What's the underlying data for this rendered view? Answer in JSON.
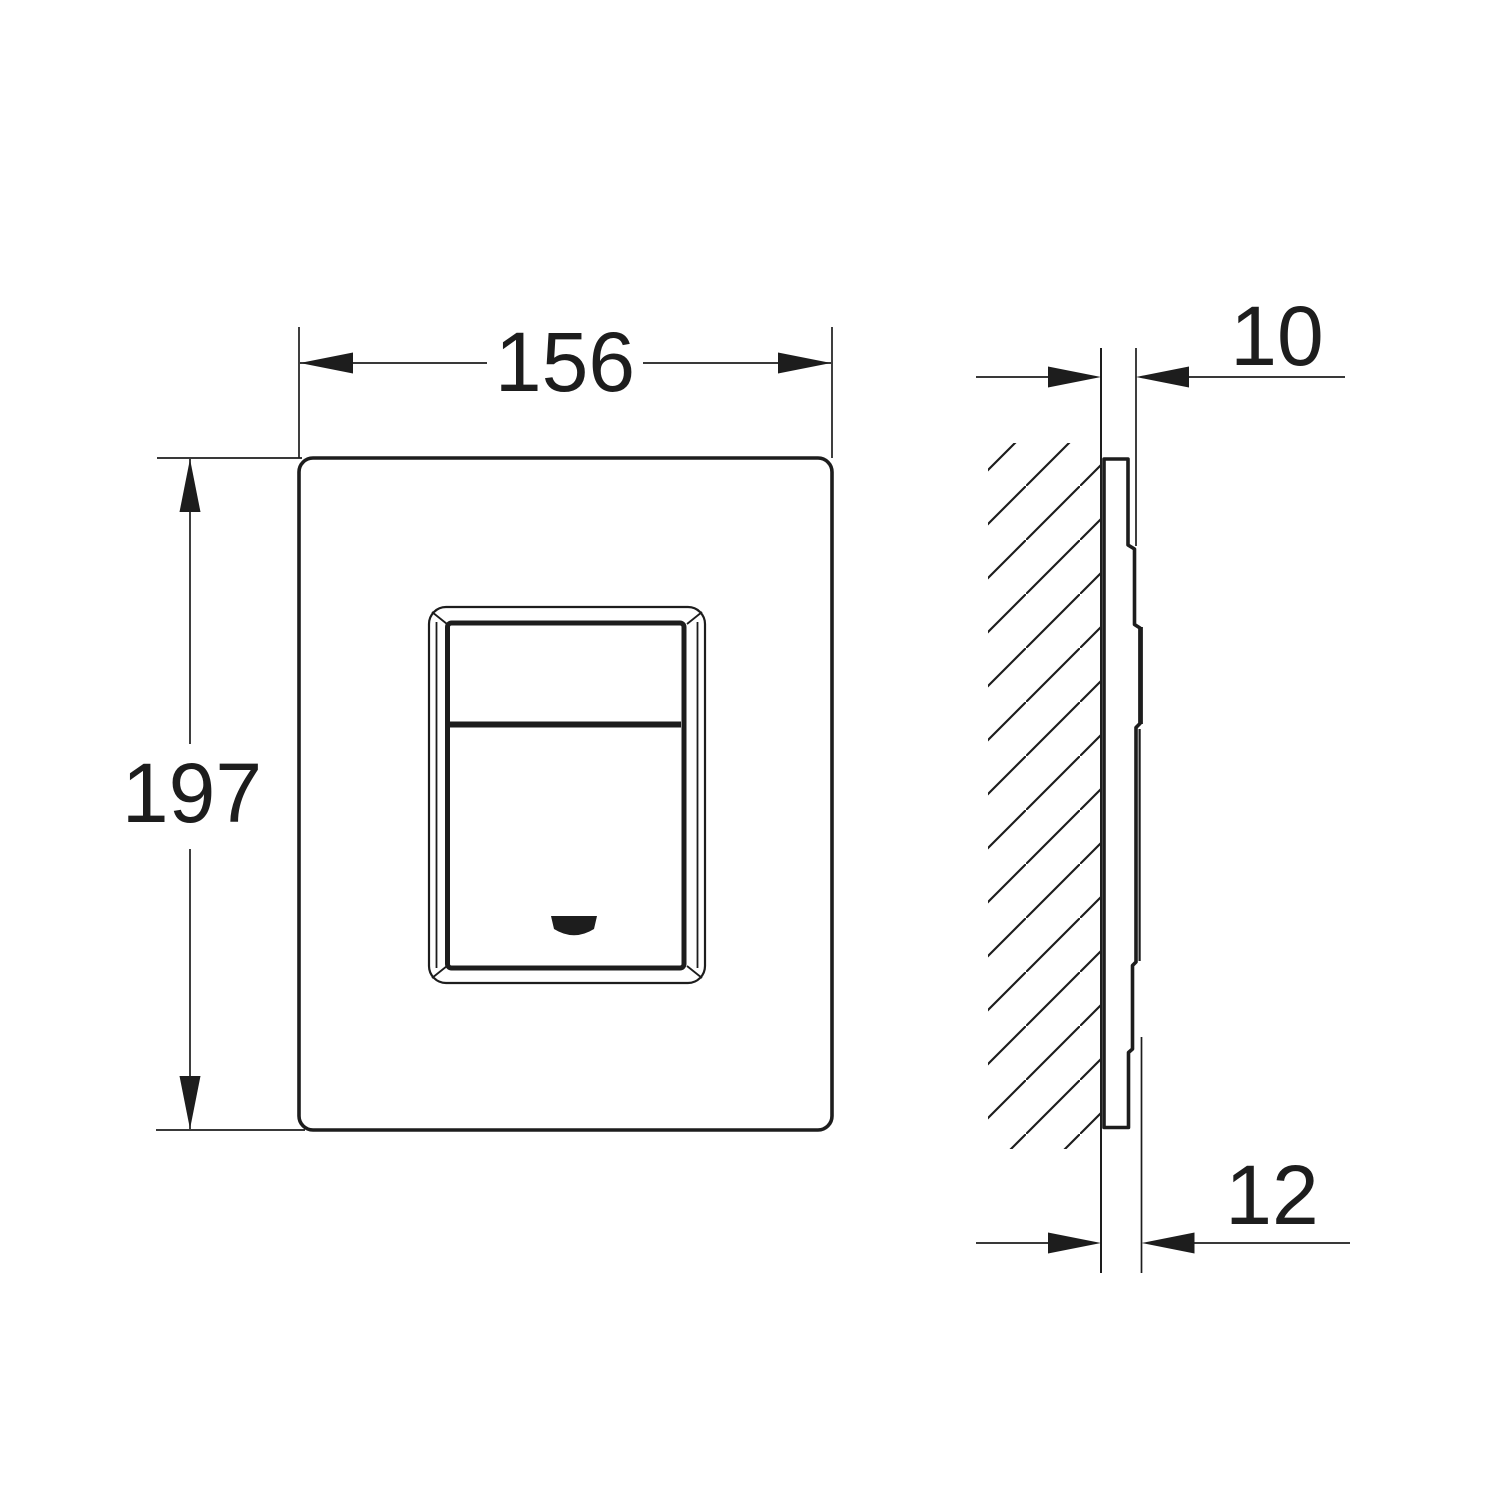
{
  "drawing": {
    "type": "technical-dimension-drawing",
    "dimension_labels": {
      "width": "156",
      "height": "197",
      "plate_depth": "10",
      "total_depth": "12"
    },
    "icons": {
      "logo_mark": "grohe-logo"
    },
    "colors": {
      "line": "#1d1d1d",
      "background": "#ffffff"
    }
  }
}
